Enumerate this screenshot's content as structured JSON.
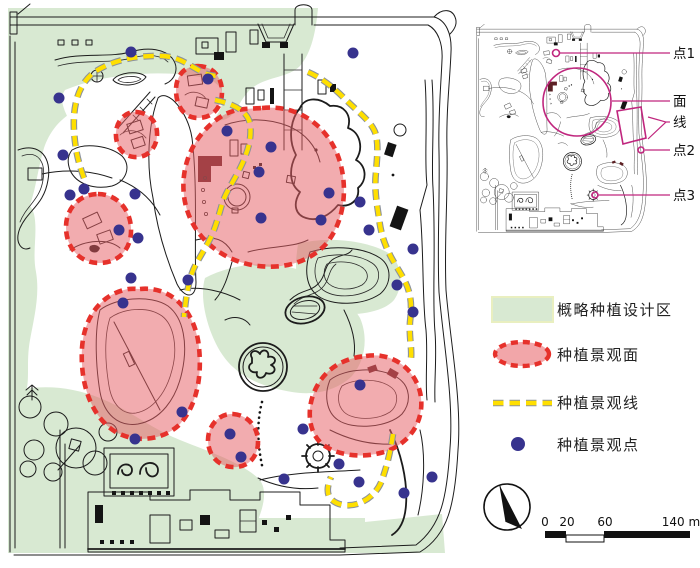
{
  "inset": {
    "labels": [
      {
        "text": "点1"
      },
      {
        "text": "面"
      },
      {
        "text": "线"
      },
      {
        "text": "点2"
      },
      {
        "text": "点3"
      }
    ]
  },
  "legend": {
    "items": [
      {
        "label": "概略种植设计区",
        "swatch": "green-area"
      },
      {
        "label": "种植景观面",
        "swatch": "red-dashed-surface"
      },
      {
        "label": "种植景观线",
        "swatch": "yellow-dashed-line"
      },
      {
        "label": "种植景观点",
        "swatch": "blue-point"
      }
    ]
  },
  "scale_bar": {
    "ticks": [
      "0",
      "20",
      "60"
    ],
    "end_label": "140 m"
  },
  "colors": {
    "planting_area_green": "#d8e9d2",
    "surface_outline_red": "#e6312b",
    "surface_fill_pink": "#f2a6a9",
    "line_yellow": "#ffdf00",
    "point_blue": "#37338e",
    "annotation_magenta": "#c0267e"
  }
}
